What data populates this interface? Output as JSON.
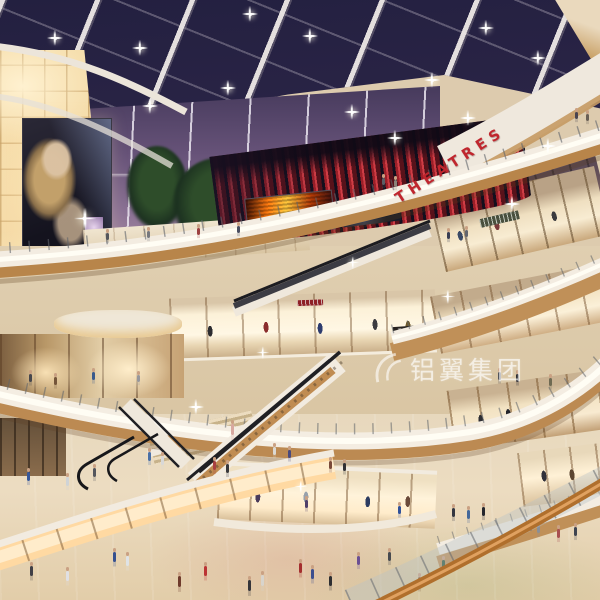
{
  "title": "Shopping mall atrium — interior architectural rendering, evening",
  "signs": {
    "theatres": "THEATRES",
    "watermark": "铝翼集团",
    "store_tai_tai": "TAI TAI"
  },
  "palette": {
    "ceiling_navy": "#2a2446",
    "dusk_sky": "#665278",
    "theatre_red": "#b2272e",
    "glow_wall": "#f6dba8",
    "fascia_white": "#f3ece1",
    "wood": "#bc8a52",
    "floor_beige": "#e7d8bd",
    "led_orange": "#ff9a1f"
  },
  "people": [
    [
      113,
      552,
      "#35508f",
      10
    ],
    [
      126,
      556,
      "#dfe3e6",
      10
    ],
    [
      178,
      576,
      "#6f3b2c",
      11
    ],
    [
      204,
      566,
      "#bb3434",
      10
    ],
    [
      248,
      580,
      "#35353a",
      11
    ],
    [
      261,
      575,
      "#d8d4cc",
      11
    ],
    [
      299,
      563,
      "#a42e2e",
      10
    ],
    [
      311,
      569,
      "#3c4e8e",
      10
    ],
    [
      329,
      576,
      "#2e2e31",
      10
    ],
    [
      357,
      556,
      "#6b4f93",
      9
    ],
    [
      388,
      552,
      "#474a4f",
      9
    ],
    [
      418,
      577,
      "#8a6a4a",
      10
    ],
    [
      442,
      560,
      "#2f5a3f",
      9
    ],
    [
      148,
      452,
      "#4a6fa5",
      9
    ],
    [
      161,
      456,
      "#d8d8d8",
      9
    ],
    [
      213,
      461,
      "#a84040",
      9
    ],
    [
      226,
      464,
      "#37373b",
      9
    ],
    [
      273,
      447,
      "#dcd9d2",
      8
    ],
    [
      288,
      450,
      "#4a4a7c",
      8
    ],
    [
      329,
      461,
      "#7a4a3a",
      8
    ],
    [
      343,
      463,
      "#303034",
      8
    ],
    [
      452,
      508,
      "#333640",
      9
    ],
    [
      467,
      510,
      "#44689a",
      9
    ],
    [
      482,
      507,
      "#24262c",
      9
    ],
    [
      537,
      524,
      "#8a8f96",
      9
    ],
    [
      557,
      529,
      "#a84f50",
      9
    ],
    [
      574,
      527,
      "#3f4450",
      9
    ],
    [
      27,
      472,
      "#36589c",
      9
    ],
    [
      66,
      477,
      "#cfd3d6",
      9
    ],
    [
      93,
      468,
      "#54565c",
      9
    ],
    [
      30,
      566,
      "#3f3f46",
      10
    ],
    [
      66,
      571,
      "#e0e0e4",
      10
    ],
    [
      29,
      374,
      "#47474d",
      8
    ],
    [
      54,
      377,
      "#74553a",
      8
    ],
    [
      92,
      372,
      "#3a5a8c",
      8
    ],
    [
      137,
      375,
      "#97979c",
      7
    ],
    [
      106,
      233,
      "#55565c",
      7
    ],
    [
      147,
      231,
      "#77787e",
      7
    ],
    [
      197,
      228,
      "#9c4040",
      7
    ],
    [
      237,
      226,
      "#4a4e60",
      7
    ],
    [
      382,
      178,
      "#5a5e66",
      7
    ],
    [
      394,
      180,
      "#8a8279",
      7
    ],
    [
      575,
      112,
      "#4a4450",
      7
    ],
    [
      586,
      114,
      "#6a5f55",
      7
    ],
    [
      447,
      232,
      "#3a3e52",
      7
    ],
    [
      465,
      230,
      "#63666e",
      7
    ],
    [
      498,
      372,
      "#44464e",
      8
    ],
    [
      516,
      374,
      "#26262c",
      8
    ],
    [
      549,
      378,
      "#6f6a52",
      8
    ],
    [
      305,
      500,
      "#50406a",
      8
    ],
    [
      398,
      506,
      "#30519a",
      8
    ],
    [
      231,
      424,
      "#d8a8a0",
      11
    ]
  ],
  "ceiling_lights": [
    [
      55,
      38
    ],
    [
      140,
      48
    ],
    [
      228,
      88
    ],
    [
      310,
      36
    ],
    [
      352,
      112
    ],
    [
      432,
      80
    ],
    [
      486,
      28
    ],
    [
      538,
      58
    ],
    [
      250,
      14
    ],
    [
      150,
      106
    ],
    [
      395,
      138
    ],
    [
      468,
      118
    ]
  ],
  "sparkles": [
    [
      512,
      204,
      1
    ],
    [
      447,
      296,
      0.9
    ],
    [
      196,
      407,
      1
    ],
    [
      262,
      352,
      0.8
    ],
    [
      548,
      146,
      1
    ],
    [
      352,
      262,
      0.8
    ],
    [
      84,
      218,
      1.4
    ],
    [
      300,
      486,
      0.8
    ]
  ]
}
